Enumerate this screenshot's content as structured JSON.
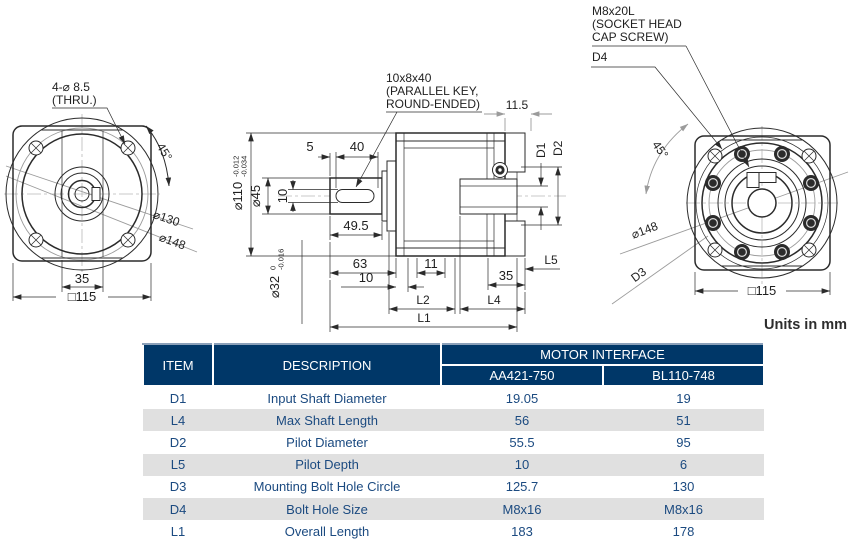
{
  "units_note": "Units in mm",
  "colors": {
    "header_bg": "#003768",
    "row_alt": "#e0e0e0",
    "table_text": "#1b4a80",
    "line_dark": "#2b2b2b",
    "line_gray": "#9b9b9b"
  },
  "drawing": {
    "front_view": {
      "bolt_callout_line1": "4-⌀ 8.5",
      "bolt_callout_line2": "(THRU.)",
      "angle": "45°",
      "dia_130": "⌀130",
      "dia_148": "⌀148",
      "dim_35": "35",
      "dim_square": "□115"
    },
    "section_view": {
      "key_callout_line1": "10x8x40",
      "key_callout_line2": "(PARALLEL KEY,",
      "key_callout_line3": "ROUND-ENDED)",
      "dim_11_5": "11.5",
      "dim_5": "5",
      "dim_40": "40",
      "dia_45": "⌀45",
      "dia_110": "⌀110",
      "dia_110_tol_upper": "-0.012",
      "dia_110_tol_lower": "-0.034",
      "dim_10_key": "10",
      "dim_49_5": "49.5",
      "dim_63": "63",
      "dim_10": "10",
      "dim_11": "11",
      "dim_35": "35",
      "dia_32": "⌀32",
      "dia_32_tol_upper": "0",
      "dia_32_tol_lower": "-0.016",
      "label_d1": "D1",
      "label_d2": "D2",
      "label_l1": "L1",
      "label_l2": "L2",
      "label_l4": "L4",
      "label_l5": "L5"
    },
    "rear_view": {
      "screw_callout_line1": "M8x20L",
      "screw_callout_line2": "(SOCKET HEAD",
      "screw_callout_line3": "CAP SCREW)",
      "label_d4": "D4",
      "angle": "45°",
      "dia_148": "⌀148",
      "label_d3": "D3",
      "dim_square": "□115"
    }
  },
  "table": {
    "headers": {
      "item": "ITEM",
      "description": "DESCRIPTION",
      "group": "MOTOR INTERFACE",
      "col1": "AA421-750",
      "col2": "BL110-748"
    },
    "rows": [
      {
        "item": "D1",
        "description": "Input Shaft Diameter",
        "col1": "19.05",
        "col2": "19"
      },
      {
        "item": "L4",
        "description": "Max Shaft Length",
        "col1": "56",
        "col2": "51"
      },
      {
        "item": "D2",
        "description": "Pilot Diameter",
        "col1": "55.5",
        "col2": "95"
      },
      {
        "item": "L5",
        "description": "Pilot Depth",
        "col1": "10",
        "col2": "6"
      },
      {
        "item": "D3",
        "description": "Mounting Bolt Hole Circle",
        "col1": "125.7",
        "col2": "130"
      },
      {
        "item": "D4",
        "description": "Bolt Hole Size",
        "col1": "M8x16",
        "col2": "M8x16"
      },
      {
        "item": "L1",
        "description": "Overall Length",
        "col1": "183",
        "col2": "178"
      }
    ]
  }
}
